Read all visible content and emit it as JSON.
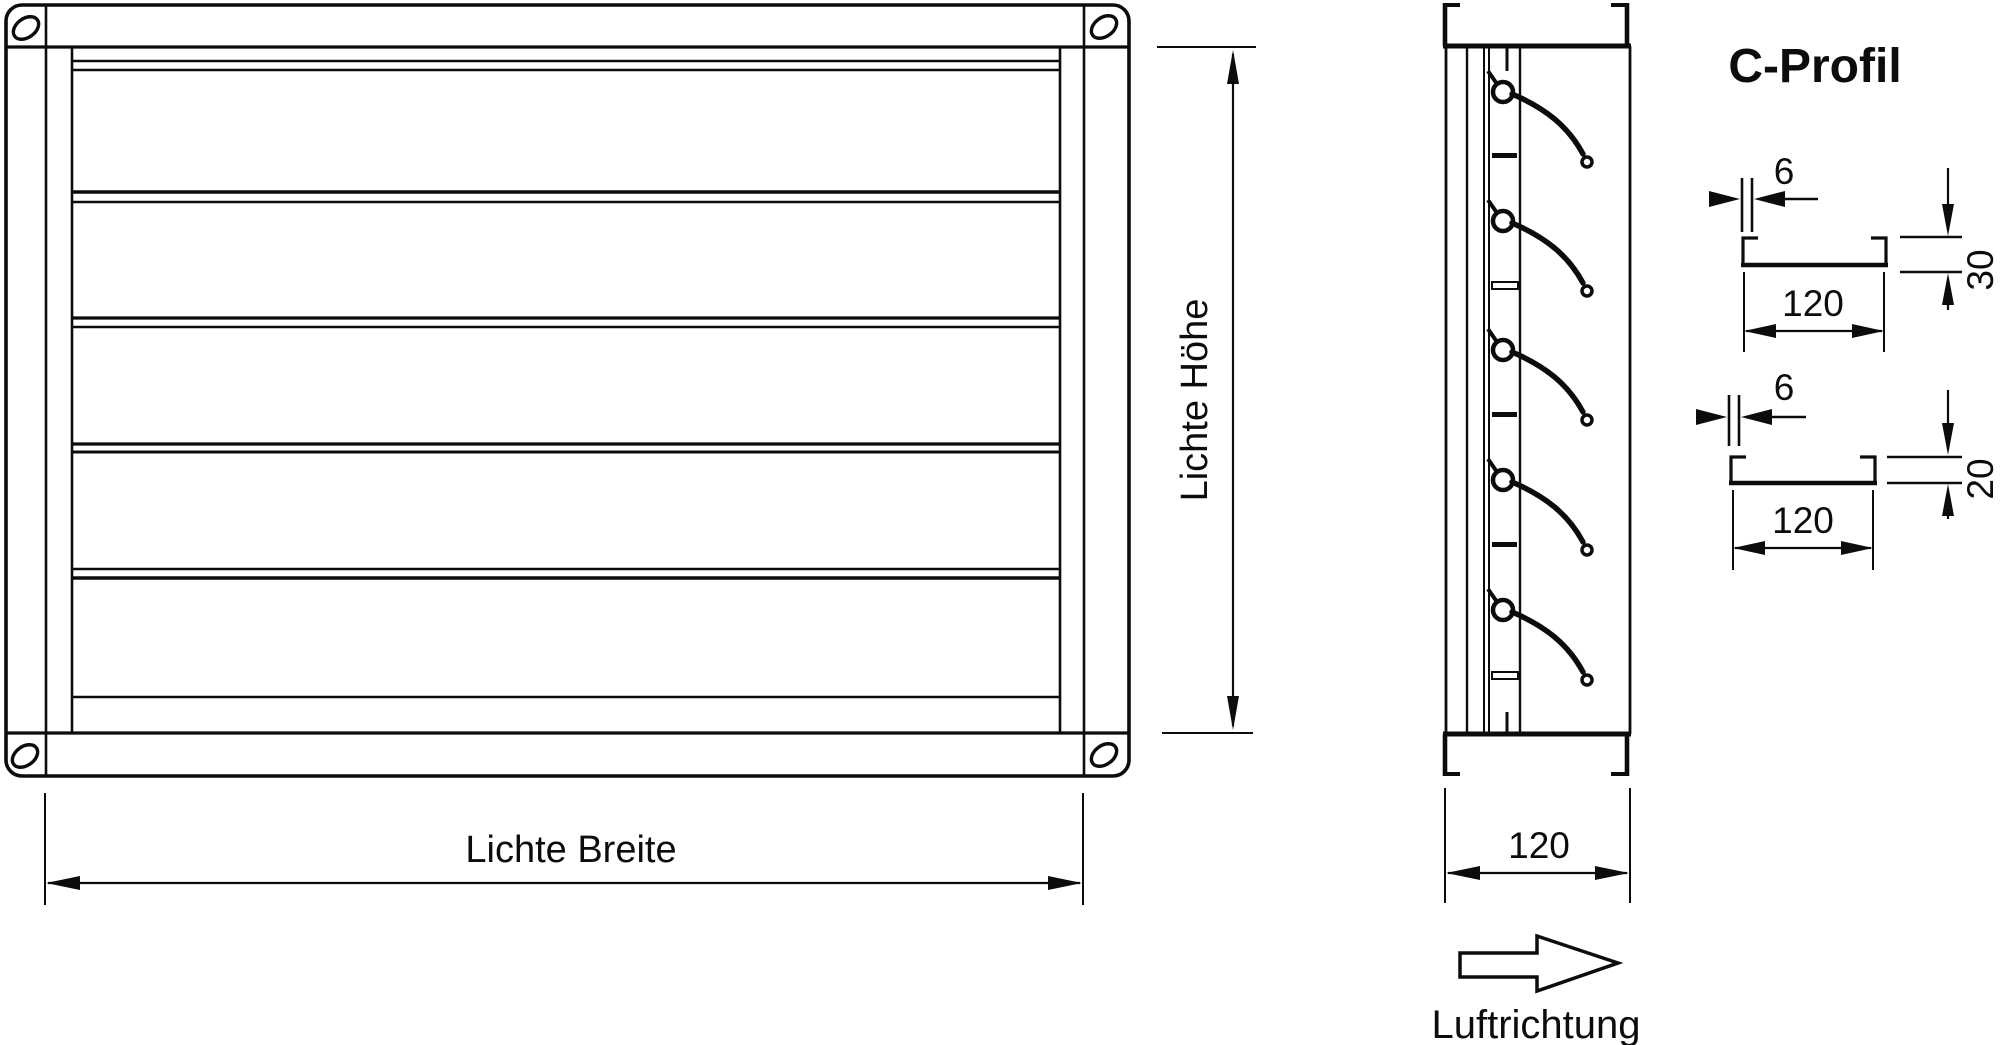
{
  "colors": {
    "line": "#0c0c0c",
    "background": "#ffffff"
  },
  "front_view": {
    "height_dim_label": "Lichte Höhe",
    "width_dim_label": "Lichte Breite"
  },
  "side_view": {
    "depth_dim_value": "120",
    "airflow_label": "Luftrichtung"
  },
  "profile_section": {
    "title": "C-Profil",
    "profiles": [
      {
        "thickness_value": "6",
        "width_value": "120",
        "height_value": "30"
      },
      {
        "thickness_value": "6",
        "width_value": "120",
        "height_value": "20"
      }
    ]
  }
}
